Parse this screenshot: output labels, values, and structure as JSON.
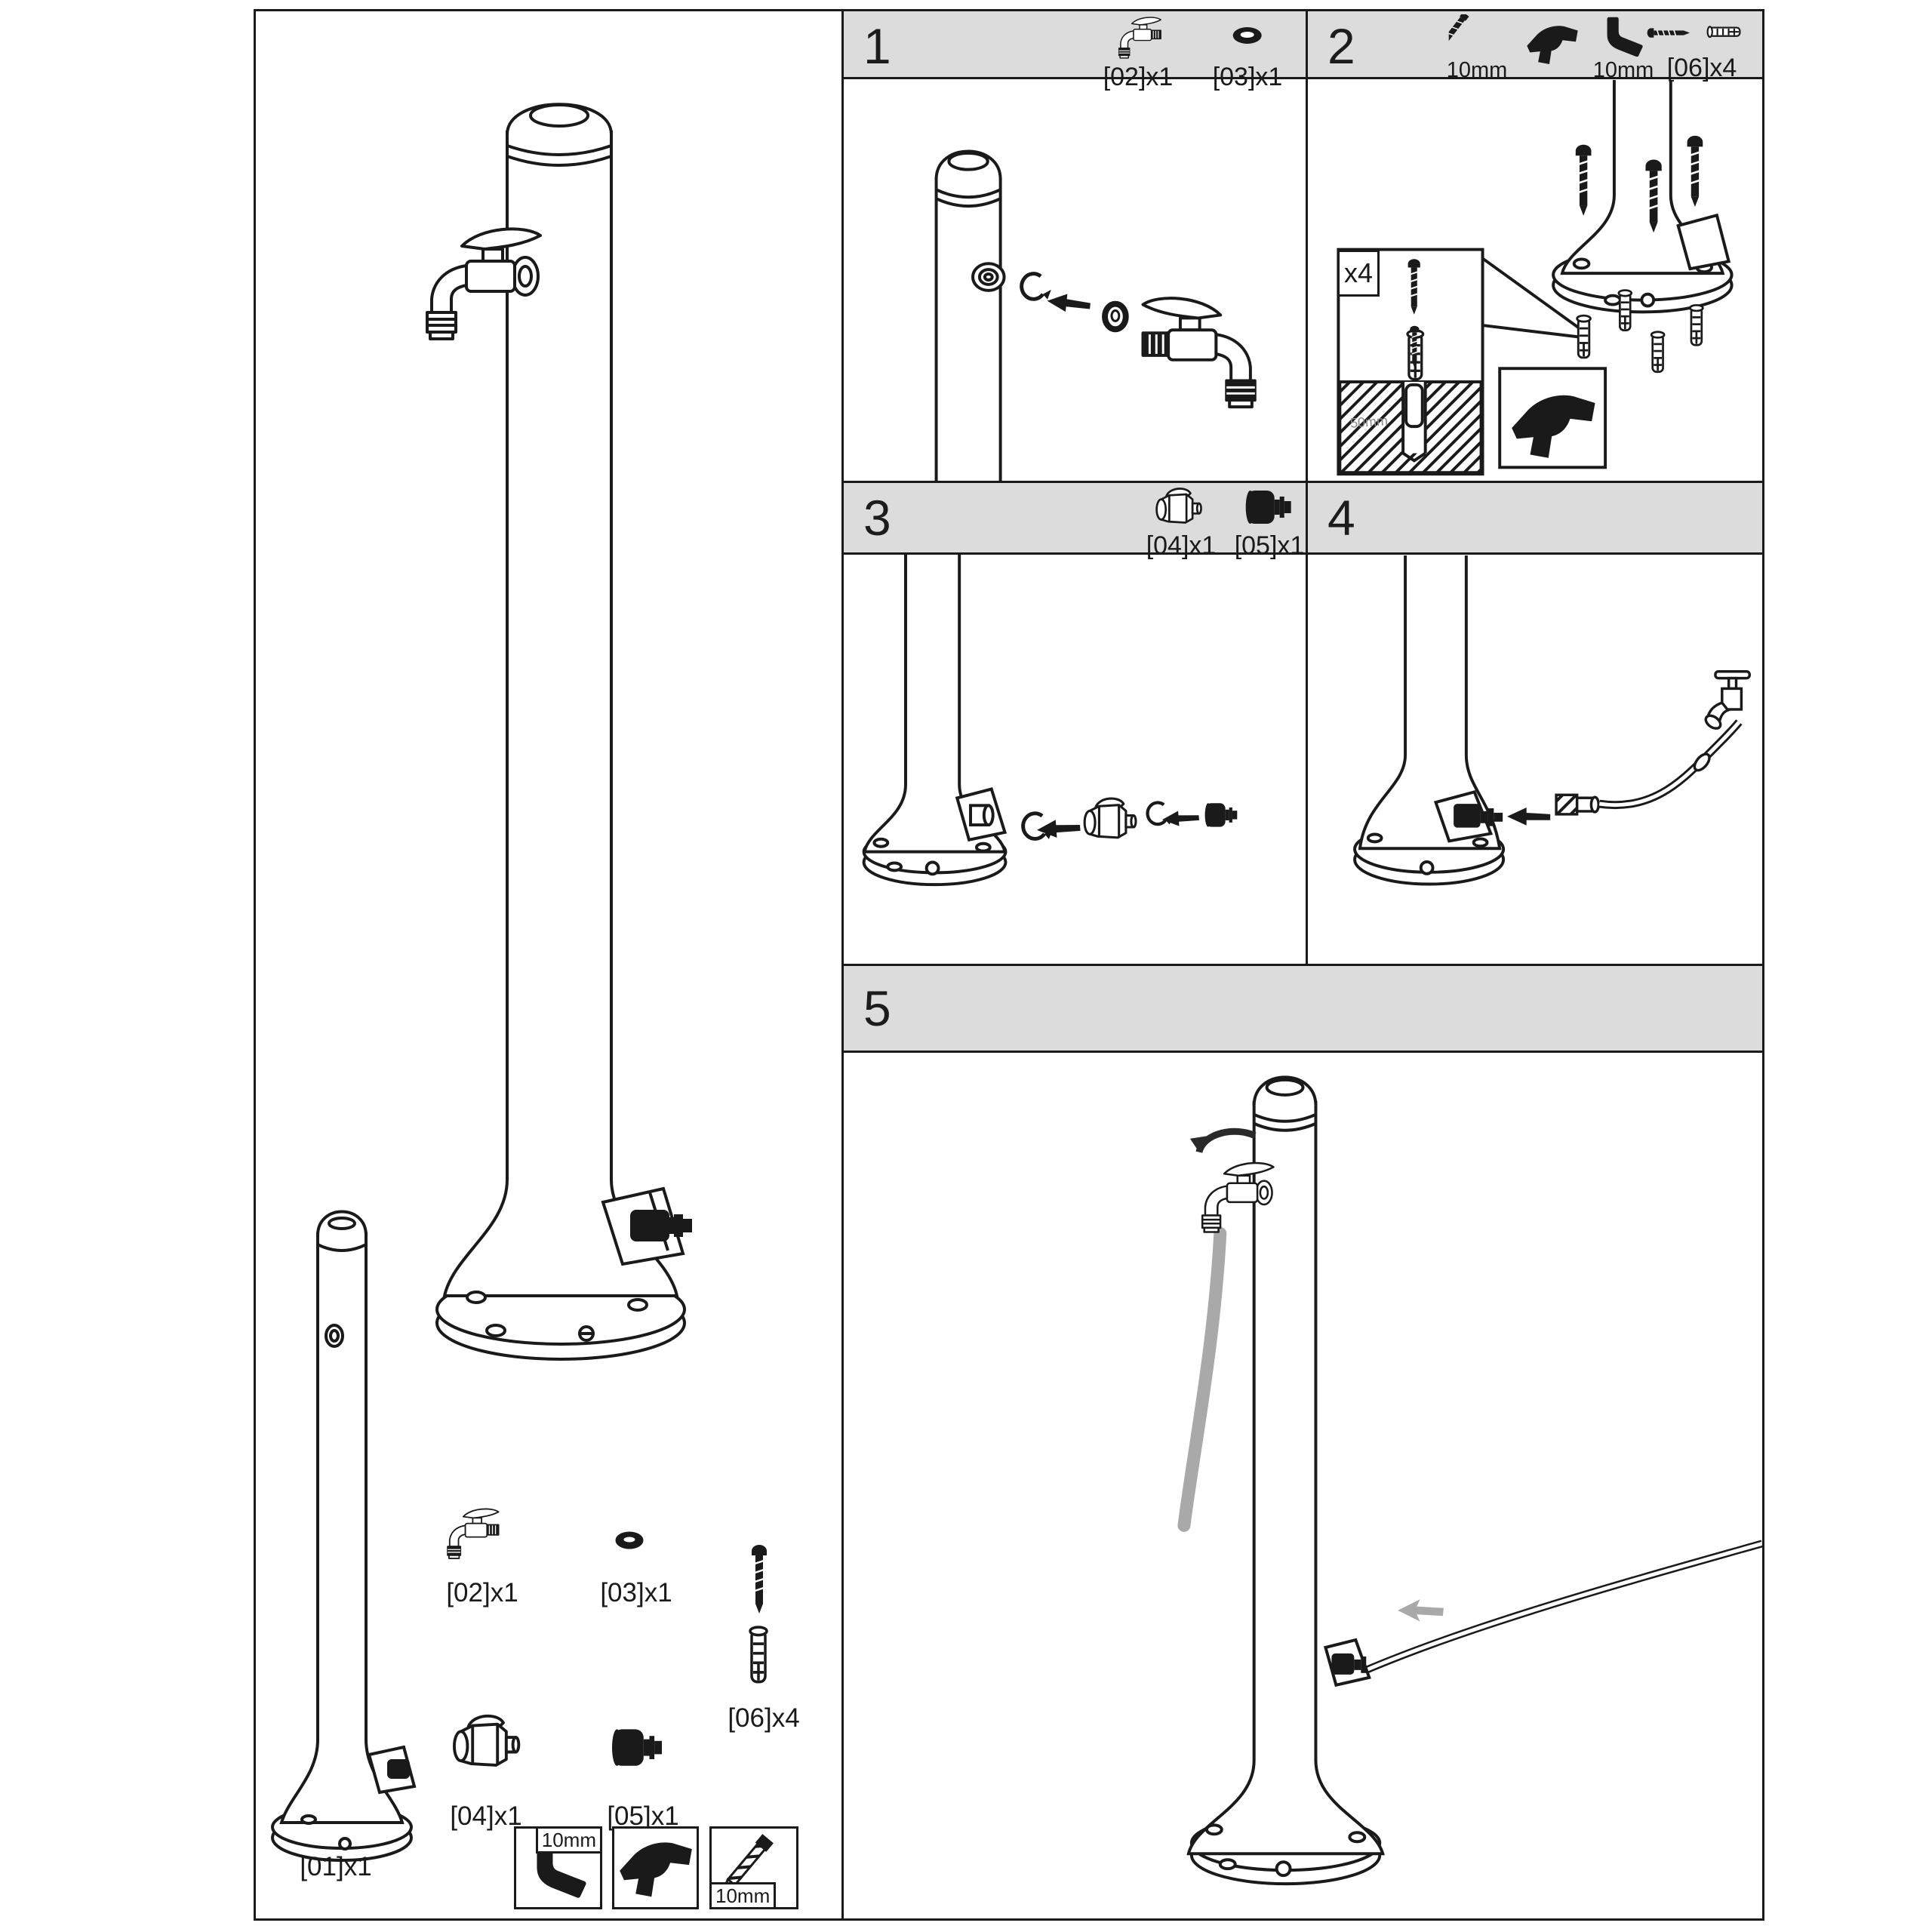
{
  "colors": {
    "header_bg": "#dcdcdc",
    "line": "#1a1a1a",
    "hose_gray": "#a9a9a9"
  },
  "steps": [
    {
      "number": "1",
      "parts": [
        {
          "label": "[02]x1",
          "icon": "tap-icon"
        },
        {
          "label": "[03]x1",
          "icon": "o-ring-icon"
        }
      ]
    },
    {
      "number": "2",
      "tools": [
        {
          "label": "10mm",
          "icon": "drill-bit-icon"
        },
        {
          "label": "",
          "icon": "drill-icon"
        },
        {
          "label": "10mm",
          "icon": "allen-key-icon"
        },
        {
          "label": "[06]x4",
          "icon": "screw-and-plug-icon"
        }
      ],
      "callout": {
        "multiplier": "x4",
        "drill_depth": "50mm"
      }
    },
    {
      "number": "3",
      "parts": [
        {
          "label": "[04]x1",
          "icon": "valve-icon"
        },
        {
          "label": "[05]x1",
          "icon": "adapter-icon"
        }
      ]
    },
    {
      "number": "4",
      "parts": []
    },
    {
      "number": "5",
      "parts": []
    }
  ],
  "parts_list": {
    "item01": "[01]x1",
    "item02": "[02]x1",
    "item03": "[03]x1",
    "item04": "[04]x1",
    "item05": "[05]x1",
    "item06": "[06]x4"
  },
  "tools": {
    "boxes": [
      {
        "icon": "socket-wrench-icon",
        "tag": "10mm"
      },
      {
        "icon": "drill-icon",
        "tag": ""
      },
      {
        "icon": "drill-bit-icon",
        "tag": "10mm"
      }
    ]
  }
}
